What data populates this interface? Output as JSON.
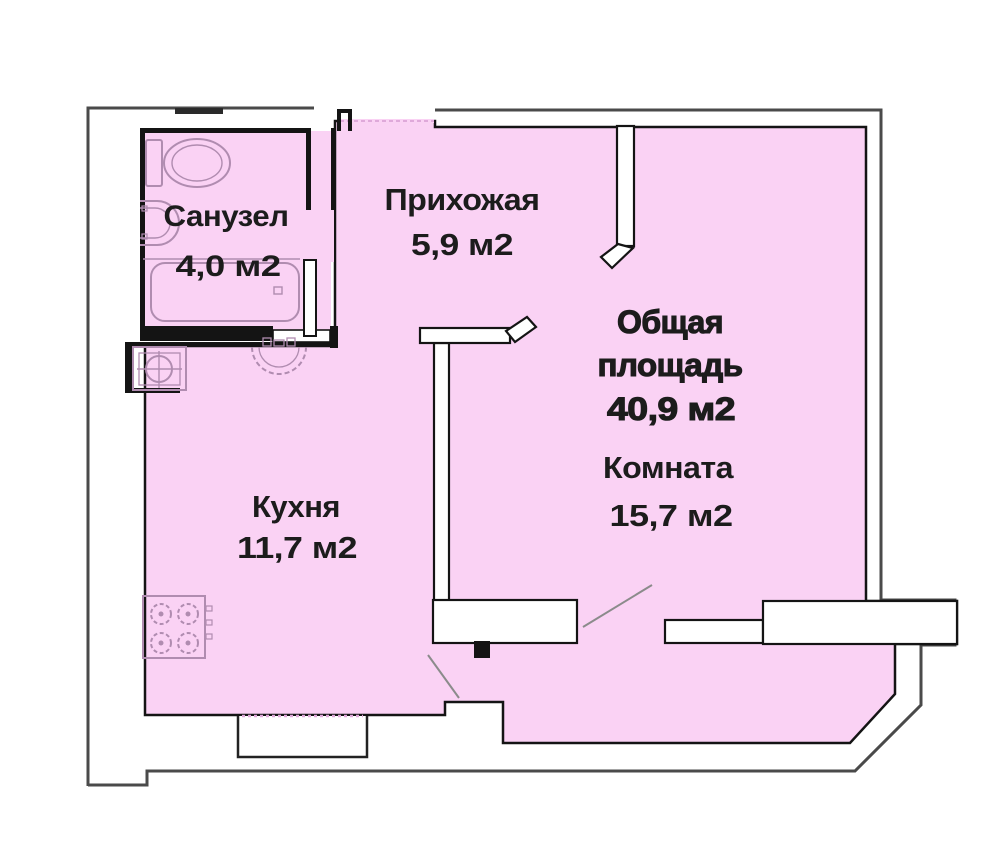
{
  "plan": {
    "type": "apartment-floor-plan",
    "rooms": {
      "bathroom": {
        "label": "Санузел",
        "area": "4,0 м2"
      },
      "hallway": {
        "label": "Прихожая",
        "area": "5,9 м2"
      },
      "kitchen": {
        "label": "Кухня",
        "area": "11,7 м2"
      },
      "living_room": {
        "label": "Комната",
        "area": "15,7 м2"
      },
      "total": {
        "label_line1": "Общая",
        "label_line2": "площадь",
        "area": "40,9 м2"
      }
    },
    "fixtures": [
      "toilet-icon",
      "bathroom-sink-icon",
      "bathtub-icon",
      "washing-machine-icon",
      "kitchen-sink-icon",
      "stove-icon"
    ],
    "colors": {
      "floor_fill": "#fad2f4",
      "wall_black": "#141414",
      "outer_wall_gray": "#4a4a4a",
      "fixture_stroke": "#b08cb0",
      "door_swing_gray": "#8b8b8b",
      "window_dotted": "#dfa9da",
      "text_color": "#1c1c1c"
    }
  }
}
